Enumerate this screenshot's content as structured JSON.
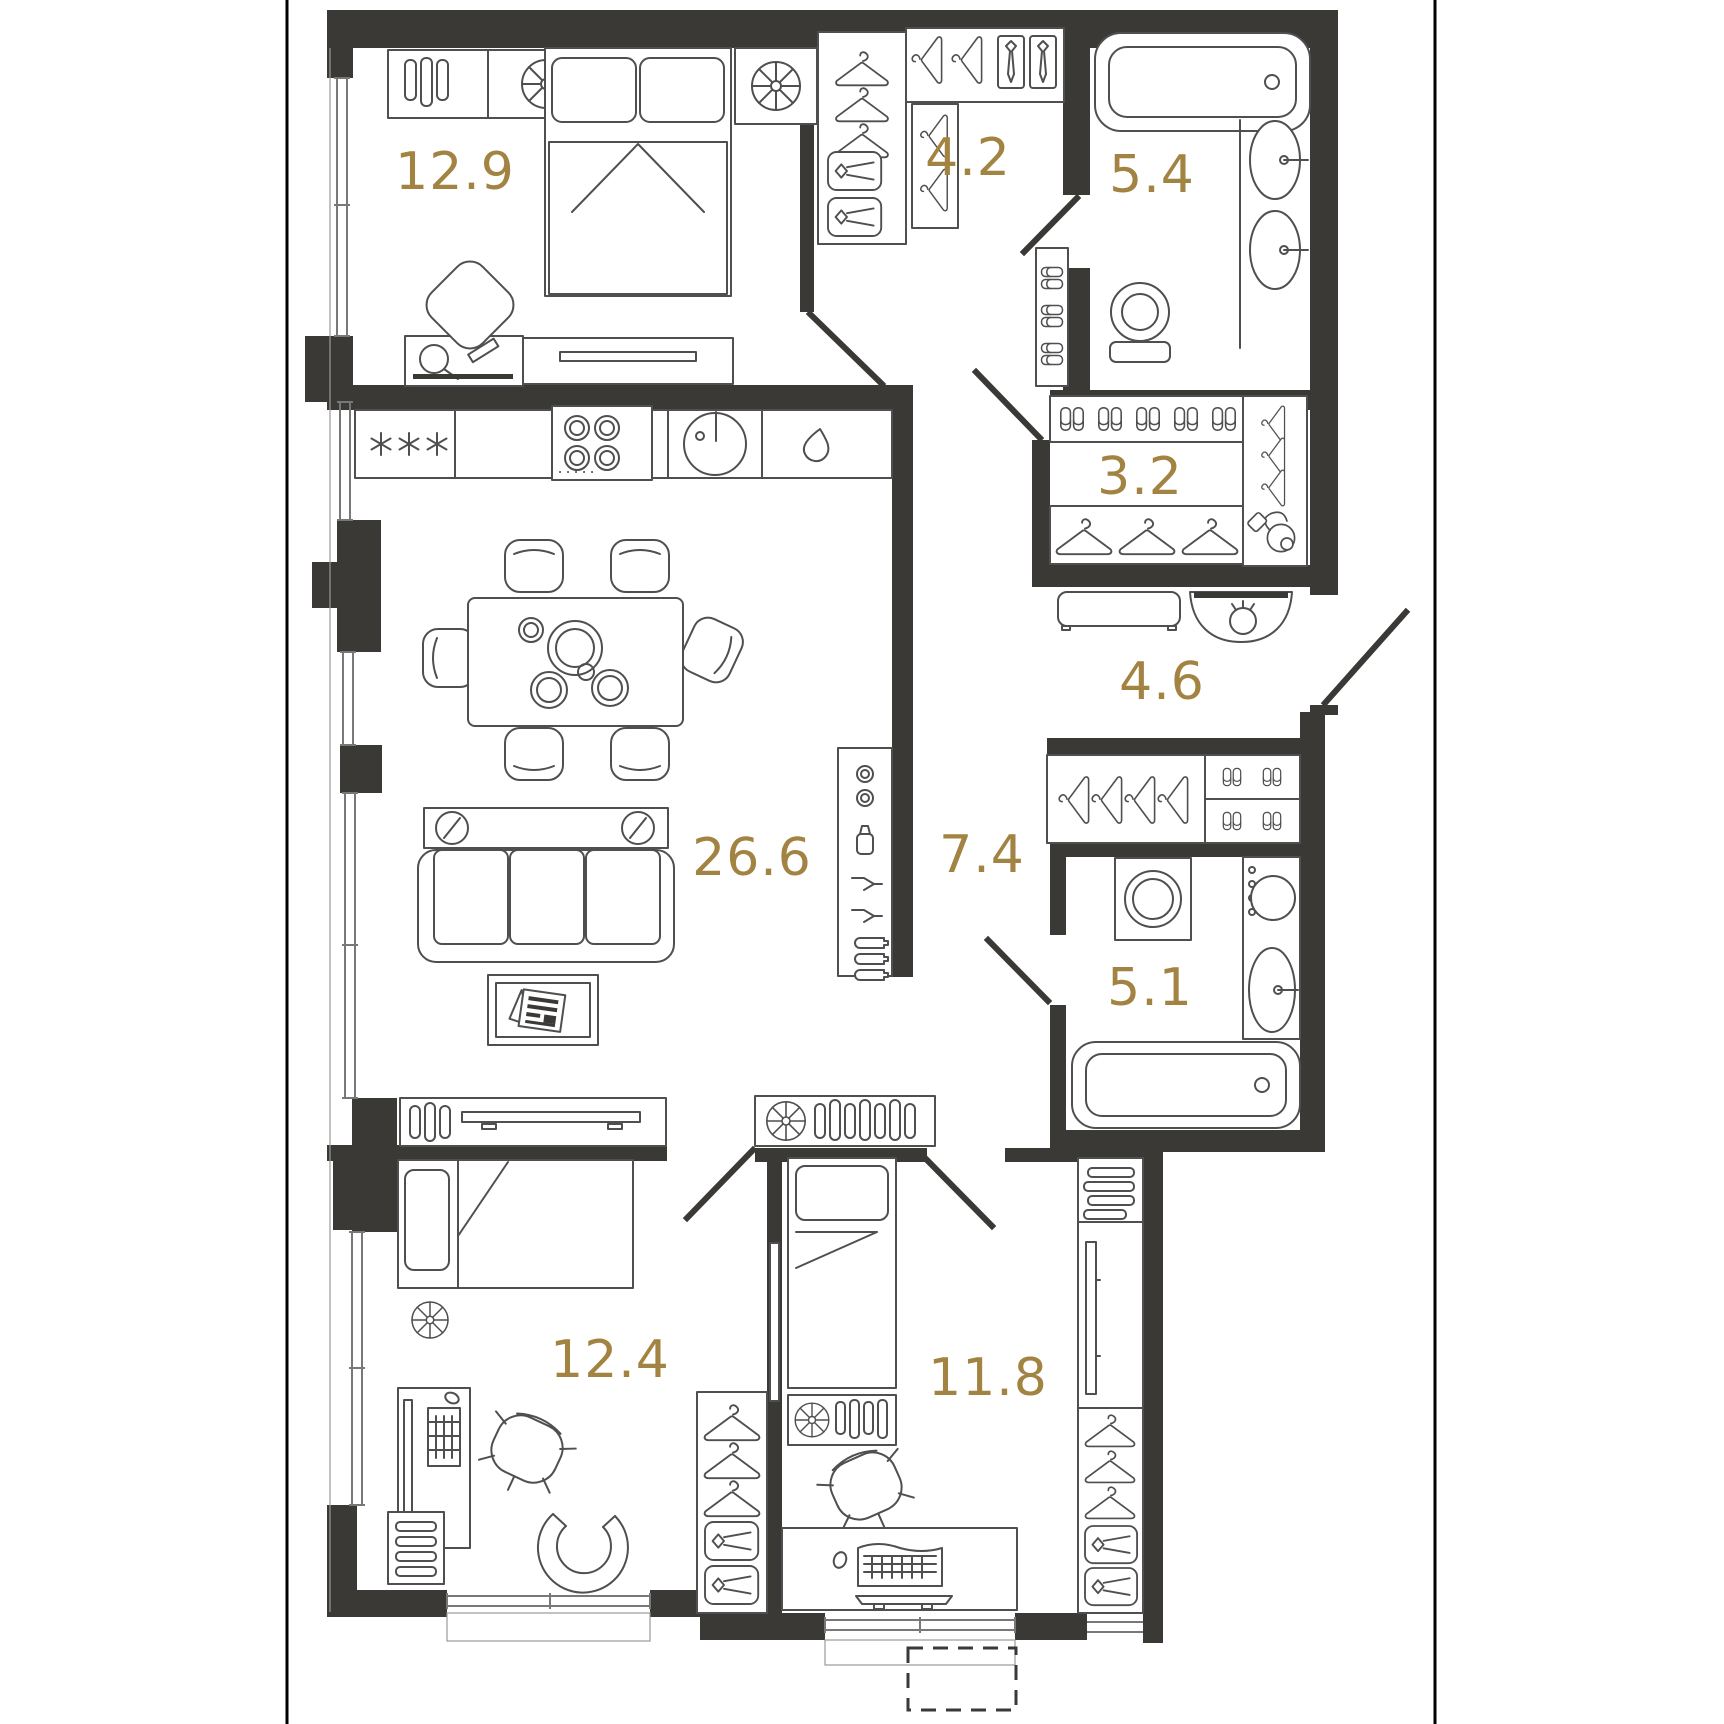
{
  "meta": {
    "type": "apartment-floor-plan",
    "room_count": 10
  },
  "colors": {
    "wall": "#3b3936",
    "furniture_line": "#4f4f4f",
    "area_label": "#a28342",
    "frame_line": "#000000",
    "background": "#ffffff",
    "window_line": "#787878"
  },
  "rooms": [
    {
      "id": "bedroom-master",
      "area": "12.9",
      "furniture": [
        "wardrobe-shelf-icon",
        "table-lamp-icon",
        "double-bed-icon",
        "nightstand-icon",
        "vanity-console-icon",
        "hand-mirror-icon",
        "tv-icon",
        "armchair-icon"
      ]
    },
    {
      "id": "walk-in-closet",
      "area": "4.2",
      "furniture": [
        "hanger-icon",
        "tie-box-icon",
        "shirt-drawer-icon"
      ]
    },
    {
      "id": "bathroom-top",
      "area": "5.4",
      "furniture": [
        "bathtub-icon",
        "sink-icon",
        "toilet-icon",
        "slipper-shelf-icon"
      ]
    },
    {
      "id": "storage-room",
      "area": "3.2",
      "furniture": [
        "slipper-shelf-icon",
        "hanger-icon",
        "vacuum-cleaner-icon"
      ]
    },
    {
      "id": "entry-hall",
      "area": "4.6",
      "furniture": [
        "bench-icon",
        "bag-console-icon",
        "entry-door"
      ]
    },
    {
      "id": "living-kitchen",
      "area": "26.6",
      "furniture": [
        "fridge-icon",
        "cooktop-icon",
        "kitchen-sink-icon",
        "dishwasher-icon",
        "dining-table-icon",
        "dining-chair-icon",
        "sofa-icon",
        "wall-shelf-icon",
        "coffee-table-icon",
        "tv-console-icon",
        "bar-cabinet-icon"
      ]
    },
    {
      "id": "corridor",
      "area": "7.4",
      "furniture": [
        "hall-wardrobe-icon",
        "slipper-shelf-icon",
        "vent-cabinet-icon"
      ]
    },
    {
      "id": "bathroom-bottom",
      "area": "5.1",
      "furniture": [
        "washing-machine-icon",
        "sink-icon",
        "bathtub-icon"
      ]
    },
    {
      "id": "bedroom-left",
      "area": "12.4",
      "furniture": [
        "single-bed-icon",
        "table-lamp-icon",
        "desk-icon",
        "desk-chair-icon",
        "lounge-chair-icon",
        "wardrobe-icon",
        "vent-grille-icon"
      ]
    },
    {
      "id": "bedroom-right",
      "area": "11.8",
      "furniture": [
        "single-bed-icon",
        "vent-cabinet-icon",
        "desk-icon",
        "desk-chair-icon",
        "wardrobe-icon",
        "tv-panel-icon"
      ]
    }
  ],
  "balcony": {
    "style": "dashed-outline"
  }
}
